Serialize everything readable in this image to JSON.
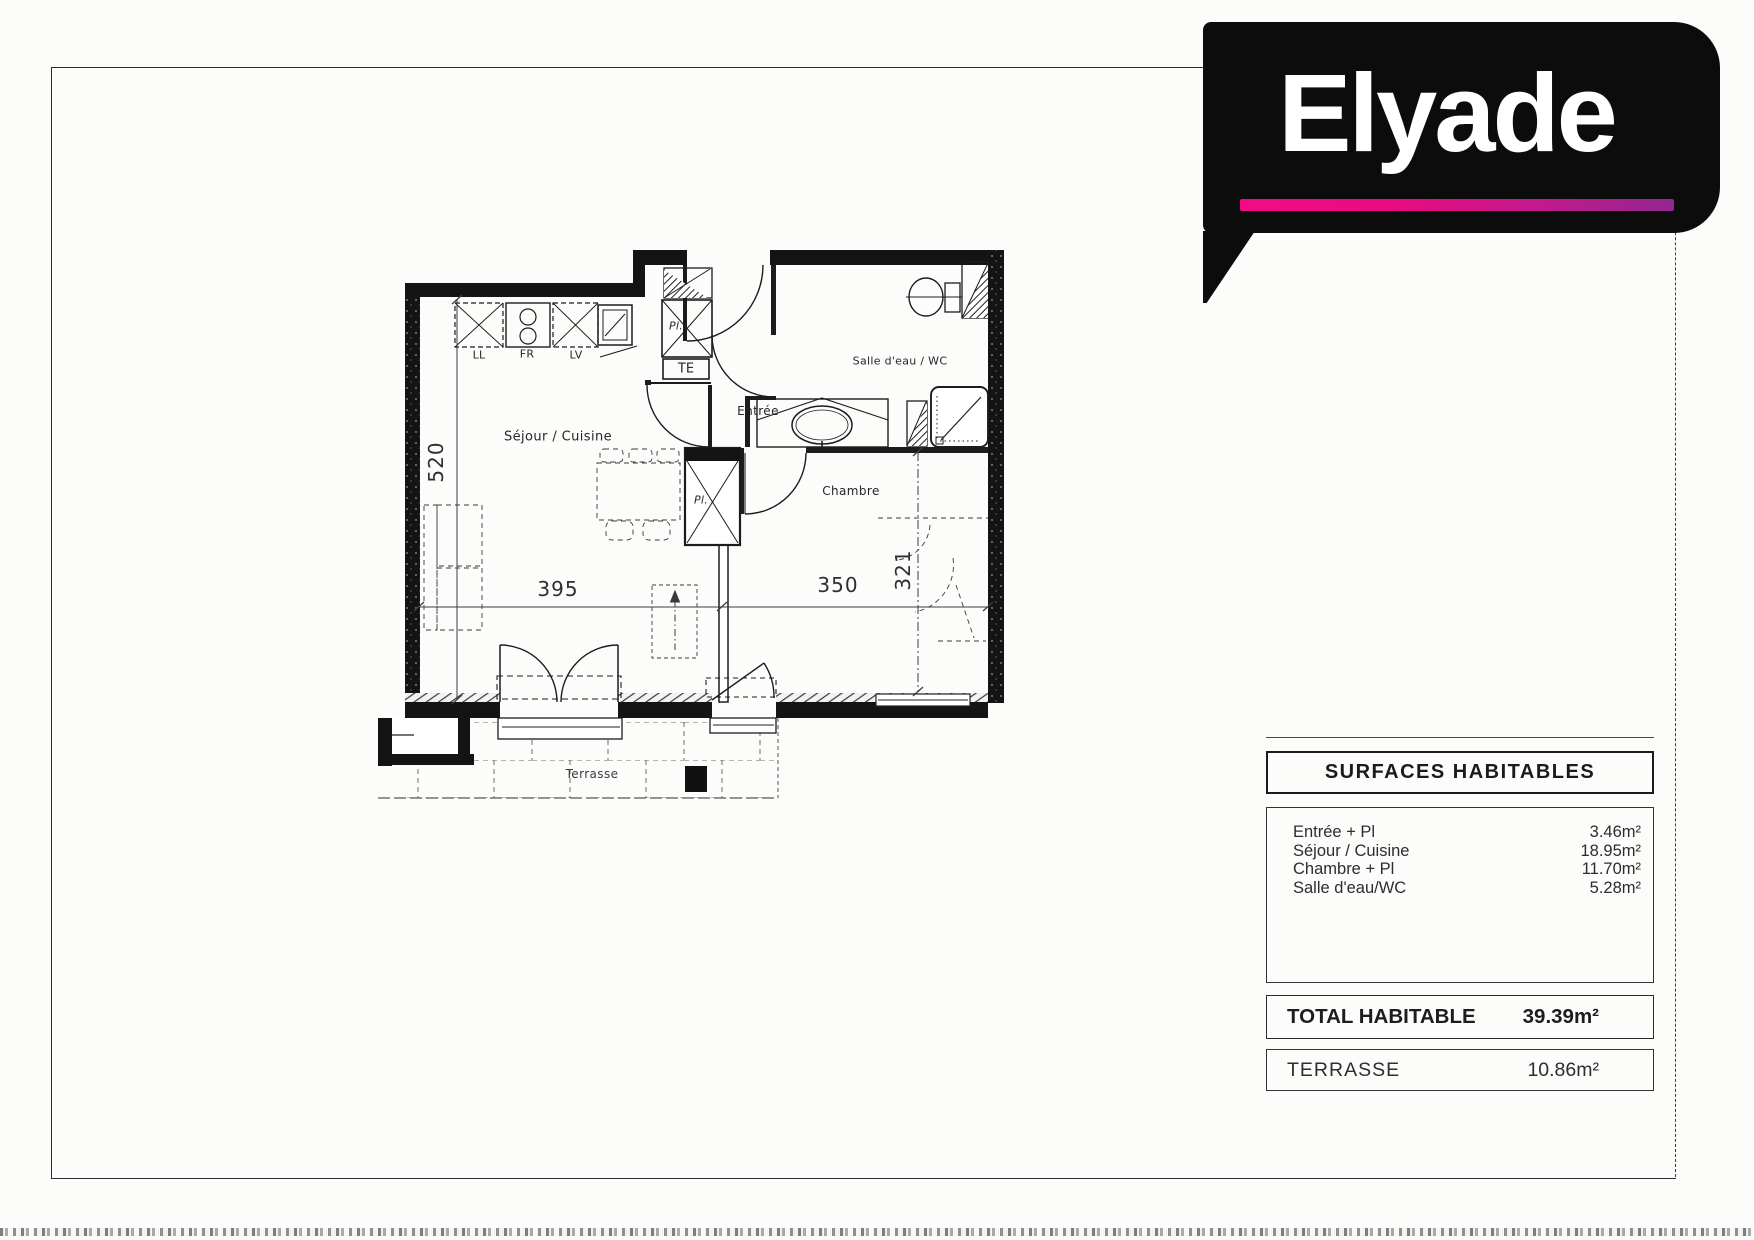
{
  "logo": {
    "text": "Elyade"
  },
  "plan": {
    "room_labels": {
      "sejour": "Séjour / Cuisine",
      "entree": "Entrée",
      "salle_deau": "Salle d'eau / WC",
      "chambre": "Chambre",
      "terrasse": "Terrasse"
    },
    "appliances": {
      "ll": "LL",
      "fr": "FR",
      "lv": "LV",
      "te": "TE"
    },
    "closets": {
      "pl_entree": "Pl.",
      "pl_chambre": "Pl."
    },
    "dimensions": {
      "sejour_width": "395",
      "chambre_width": "350",
      "sejour_height": "520",
      "chambre_height": "321"
    }
  },
  "surfaces_table": {
    "title": "SURFACES HABITABLES",
    "rows": [
      {
        "label": "Entrée + Pl",
        "value": "3.46m²"
      },
      {
        "label": "Séjour / Cuisine",
        "value": "18.95m²"
      },
      {
        "label": "Chambre + Pl",
        "value": "11.70m²"
      },
      {
        "label": "Salle d'eau/WC",
        "value": "5.28m²"
      }
    ],
    "total": {
      "label": "TOTAL HABITABLE",
      "value": "39.39m²"
    },
    "terrasse": {
      "label": "TERRASSE",
      "value": "10.86m²"
    }
  }
}
